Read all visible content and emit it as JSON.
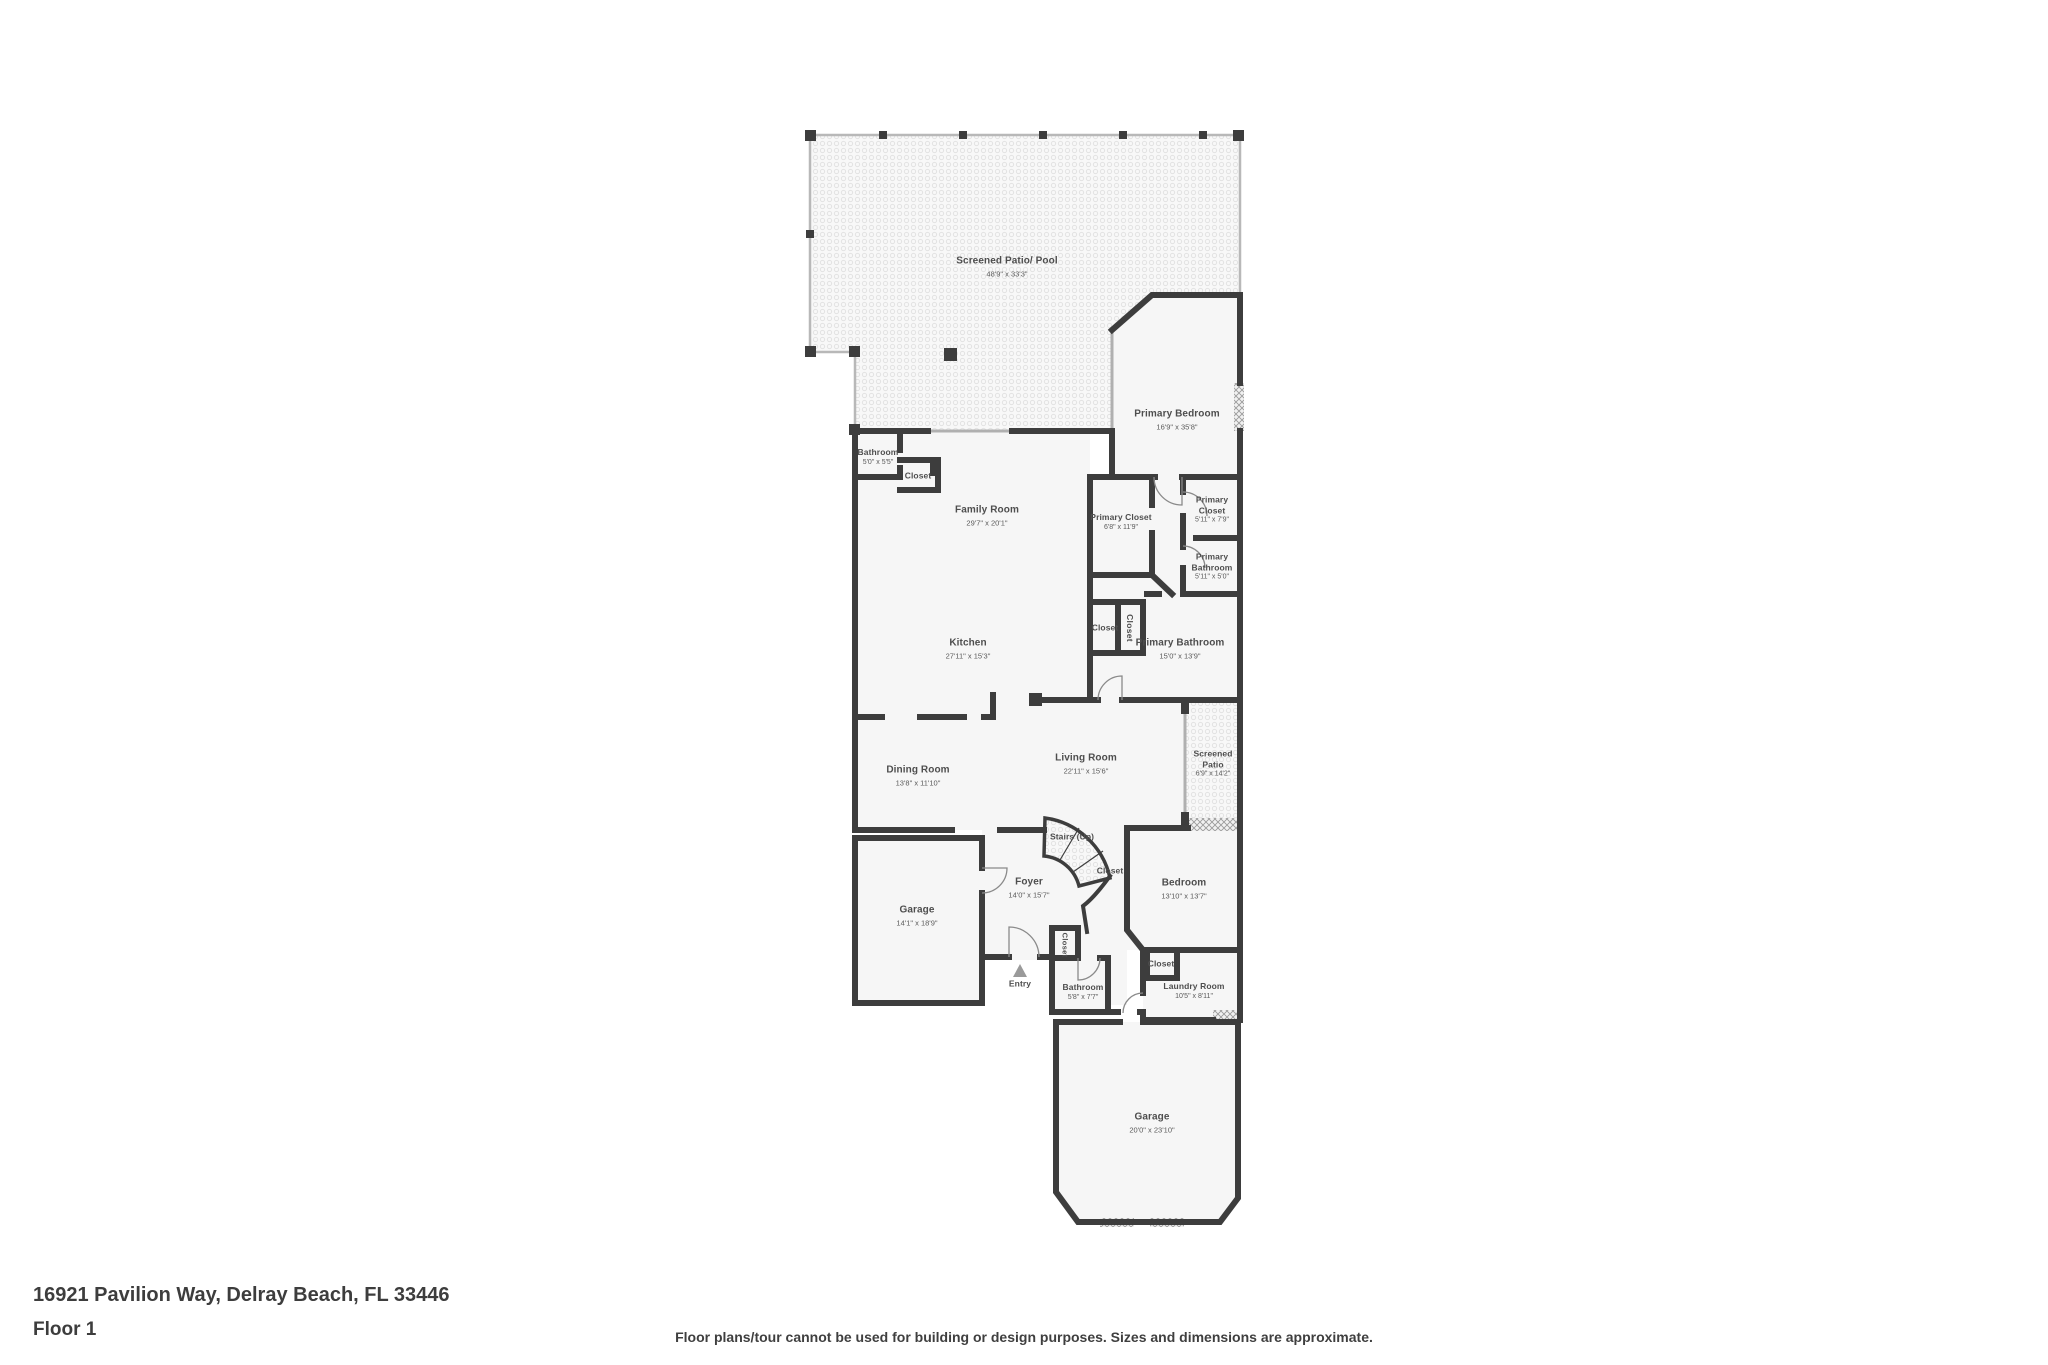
{
  "page": {
    "address": "16921 Pavilion Way, Delray Beach, FL 33446",
    "floor_label": "Floor 1",
    "disclaimer": "Floor plans/tour cannot be used for building or design purposes. Sizes and dimensions are approximate."
  },
  "colors": {
    "wall": "#3d3d3d",
    "screen_wall": "#b5b5b5",
    "room_fill": "#f6f6f6",
    "label_text": "#4e4e4e",
    "background": "#ffffff"
  },
  "rooms": [
    {
      "name": "Screened Patio/ Pool",
      "dims": "48'9\" x 33'3\""
    },
    {
      "name": "Primary Bedroom",
      "dims": "16'9\" x 35'8\""
    },
    {
      "name": "Bathroom",
      "dims": "5'0\" x 5'5\""
    },
    {
      "name": "Closet"
    },
    {
      "name": "Family Room",
      "dims": "29'7\" x 20'1\""
    },
    {
      "name": "Primary Closet",
      "dims": "6'8\" x 11'9\""
    },
    {
      "name": "Primary Closet",
      "dims": "5'11\" x 7'9\""
    },
    {
      "name": "Primary Bathroom",
      "dims": "5'11\" x 5'0\""
    },
    {
      "name": "Closet"
    },
    {
      "name": "Closet"
    },
    {
      "name": "Primary Bathroom",
      "dims": "15'0\" x 13'9\""
    },
    {
      "name": "Kitchen",
      "dims": "27'11\" x 15'3\""
    },
    {
      "name": "Living Room",
      "dims": "22'11\" x 15'6\""
    },
    {
      "name": "Screened Patio",
      "dims": "6'9\" x 14'2\""
    },
    {
      "name": "Dining Room",
      "dims": "13'8\" x 11'10\""
    },
    {
      "name": "Stairs (Up)"
    },
    {
      "name": "Closet"
    },
    {
      "name": "Foyer",
      "dims": "14'0\" x 15'7\""
    },
    {
      "name": "Bedroom",
      "dims": "13'10\" x 13'7\""
    },
    {
      "name": "Garage",
      "dims": "14'1\" x 18'9\""
    },
    {
      "name": "Closet"
    },
    {
      "name": "Entry"
    },
    {
      "name": "Bathroom",
      "dims": "5'8\" x 7'7\""
    },
    {
      "name": "Closet"
    },
    {
      "name": "Laundry Room",
      "dims": "10'5\" x 8'11\""
    },
    {
      "name": "Garage",
      "dims": "20'0\" x 23'10\""
    }
  ]
}
